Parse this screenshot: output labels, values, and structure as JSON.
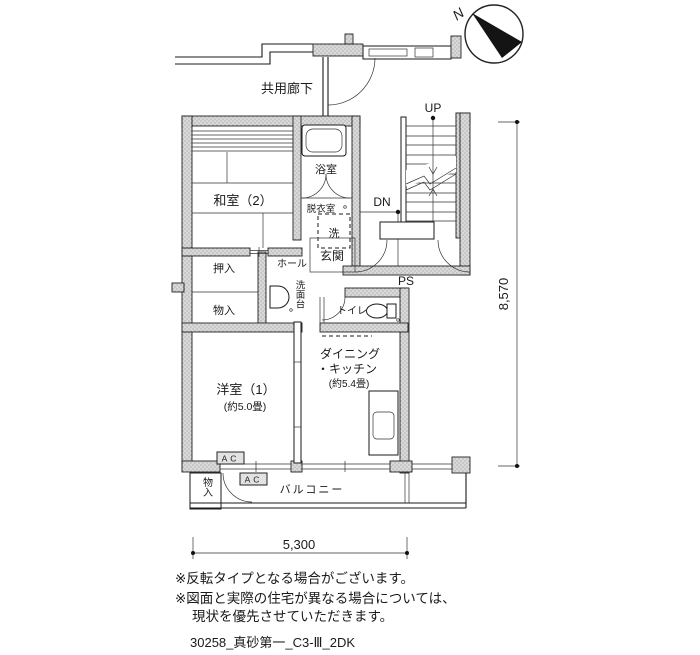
{
  "compass": {
    "north_label": "N"
  },
  "labels": {
    "corridor": "共用廊下",
    "bath": "浴室",
    "dressing": "脱衣室",
    "washer": "洗",
    "washitsu2": "和室（2）",
    "up": "UP",
    "dn": "DN",
    "genkan": "玄関",
    "ps": "PS",
    "hall": "ホール",
    "vanity": "洗面台",
    "oshiire": "押入",
    "storage1": "物入",
    "toilet": "トイレ",
    "dining_line1": "ダイニング",
    "dining_line2": "・キッチン",
    "dining_size": "(約5.4畳)",
    "western1": "洋室（1）",
    "western1_size": "(約5.0畳)",
    "ac": "AC",
    "balcony": "バルコニー",
    "storage2": "物入"
  },
  "dimensions": {
    "width_mm": "5,300",
    "height_mm": "8,570"
  },
  "notes": [
    "※反転タイプとなる場合がございます。",
    "※図面と実際の住宅が異なる場合については、",
    "現状を優先させていただきます。"
  ],
  "plan_id": "30258_真砂第一_C3-Ⅲ_2DK",
  "colors": {
    "wall_fill": "#d9d9d9",
    "wall_dot": "#9a9a9a",
    "line": "#1a1a1a",
    "background": "#ffffff"
  }
}
